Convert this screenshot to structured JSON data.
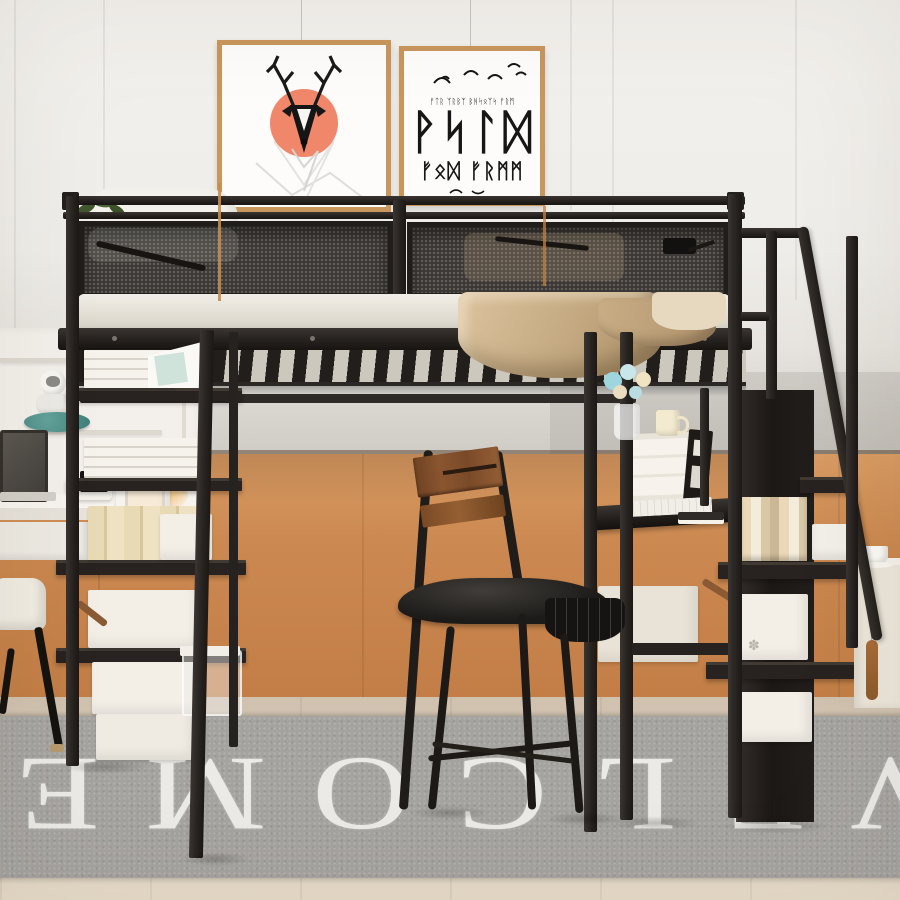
{
  "scene": {
    "description": "Bedroom product photo: black metal loft bed with under-bed desk, ladder shelves and storage staircase against a white-and-orange panelled wall",
    "rug": {
      "text": "WELCOME",
      "orientation": "rotated-180",
      "bg_color": "#a5a3a0",
      "text_color": "#efeeea"
    },
    "posters": {
      "deer_label": "geometric-deer-print",
      "runes_top": "ᚠᛏᚱ ᛉᚱᛒᛉ ᛒᚻᛋᛟᛉᛋ ᚠᚱᛗ",
      "runes_large": "ᚹᛋᛚᛞ",
      "runes_bottom": "ᚠᛟᛞ ᚠᚱᛗᛗ"
    },
    "box_logo_glyph": "✽",
    "colors": {
      "metal_frame": "#2a2522",
      "wall_upper": "#f0eeea",
      "wall_wainscot_orange": "#cd8a51",
      "gray_band": "#c9c5c0",
      "floor_wood": "#dbcdbb",
      "rug_gray": "#a5a3a0",
      "mattress_white": "#edeae3",
      "blanket_tan": "#c9ae88",
      "chair_wood": "#84502c",
      "poster_frame_gold": "#c9965c",
      "accent_salmon": "#ef8a68",
      "teal_decor": "#4d8e88"
    }
  }
}
